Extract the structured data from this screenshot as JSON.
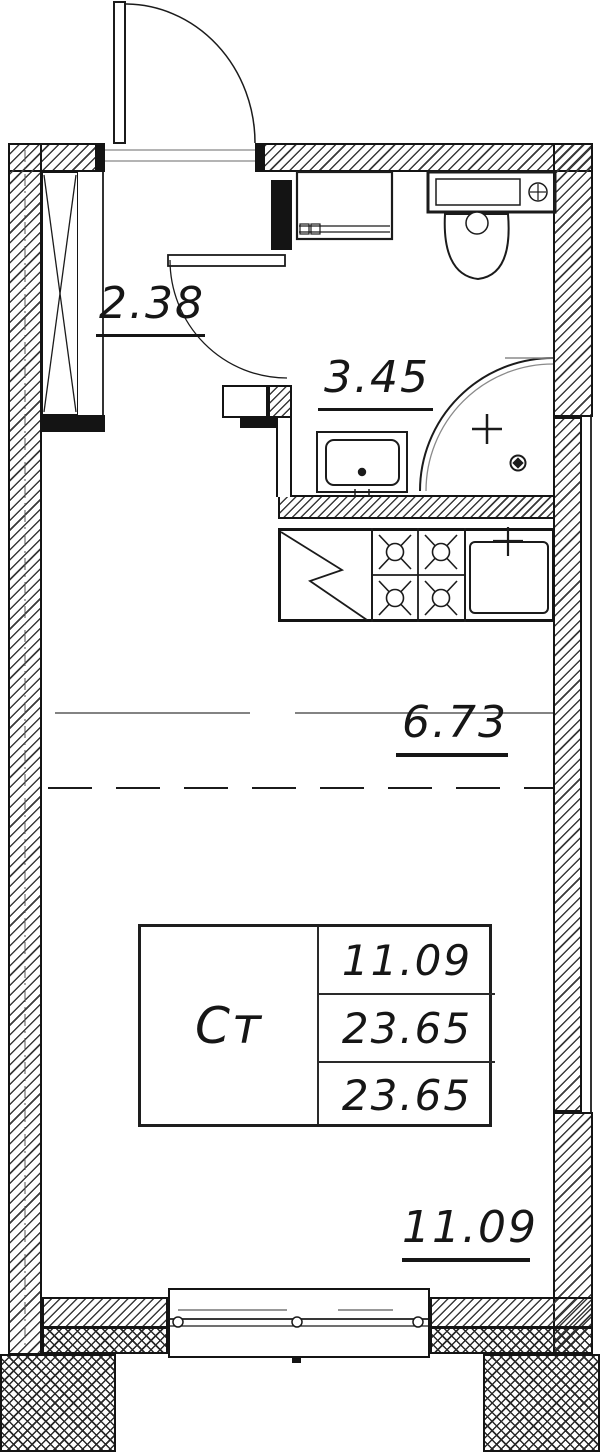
{
  "plan": {
    "drawing_type": "studio-apartment-floor-plan",
    "rooms": {
      "hallway": {
        "area": "2.38"
      },
      "bathroom": {
        "area": "3.45"
      },
      "kitchen_zone": {
        "area": "6.73"
      },
      "living_zone": {
        "area": "11.09"
      }
    },
    "summary_table": {
      "type_label": "Ст",
      "rows": [
        "11.09",
        "23.65",
        "23.65"
      ]
    },
    "fixtures": [
      "entrance-door",
      "wardrobe-shaft",
      "bathroom-door",
      "washing-machine",
      "toilet",
      "wash-basin",
      "shower",
      "kitchen-counter",
      "stove",
      "kitchen-sink",
      "window"
    ],
    "colors": {
      "line": "#1b1b1b",
      "secondary_line": "#777777",
      "background": "#ffffff"
    }
  }
}
